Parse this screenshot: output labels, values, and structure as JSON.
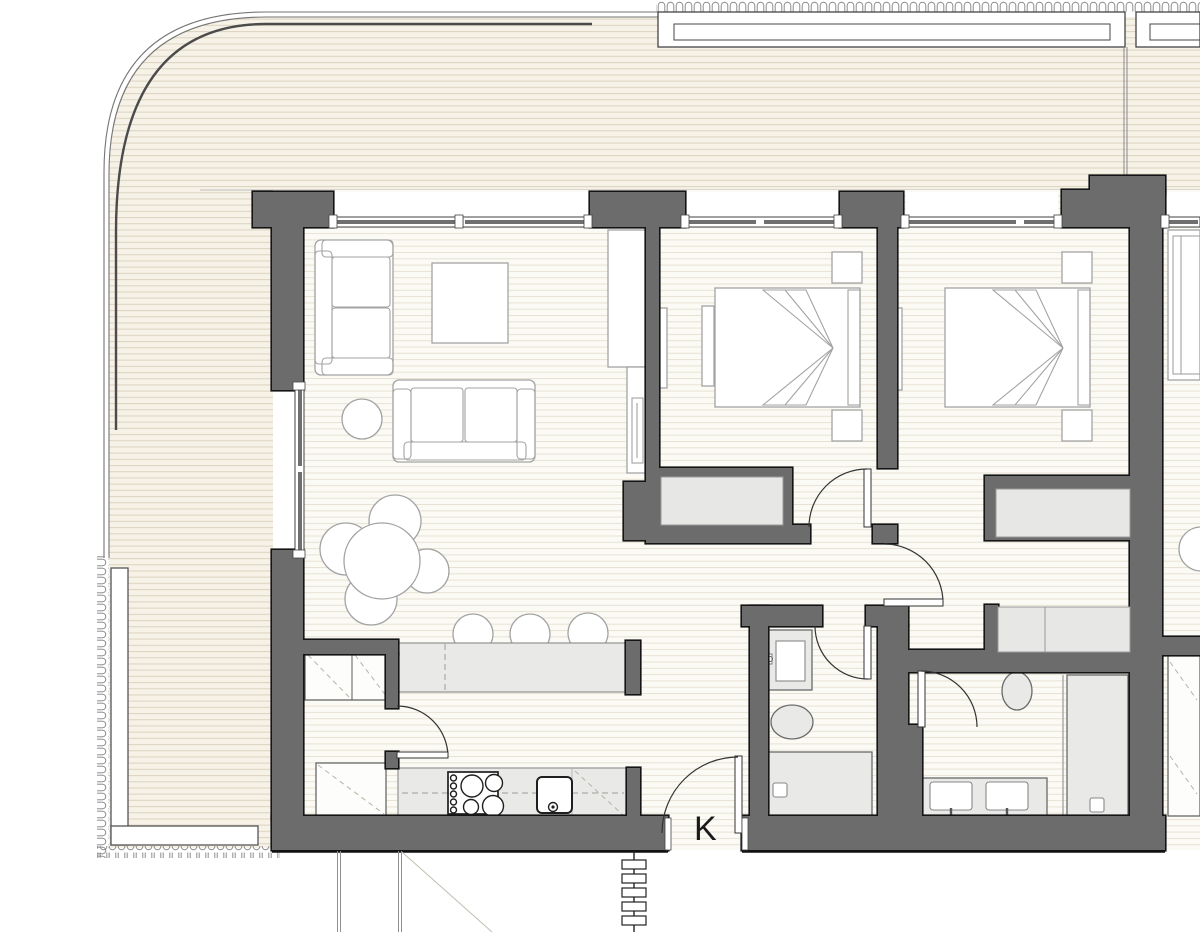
{
  "plan": {
    "entrance_label": "K"
  },
  "colors": {
    "wall": "#6c6c6c",
    "wall_edge": "#141414",
    "terrace_bg": "#f6f2e8",
    "terrace_line": "#ded5c2",
    "floor_bg": "#fbfaf5",
    "floor_line": "#e8e2d4",
    "counter_fill": "#e9e9e8",
    "fixture_fill": "#e9e9e8",
    "furn_line": "#a3a3a3",
    "door_line": "#333333"
  }
}
